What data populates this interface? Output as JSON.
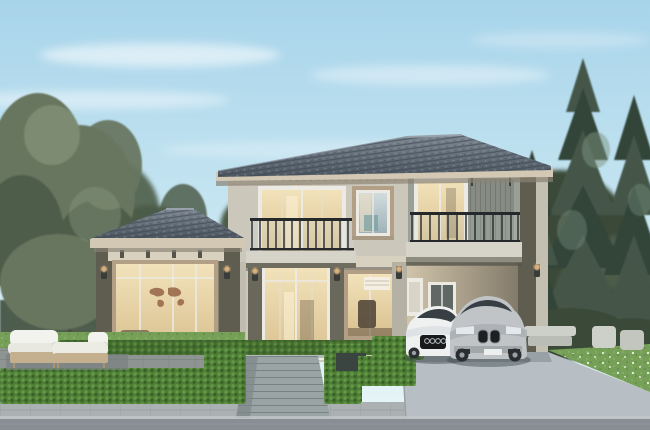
{
  "scene": {
    "type": "architectural-exterior-rendering",
    "caption": "Two-story modern tropical house rendering at dusk with lit interiors, landscaped hedges, patio furniture and two cars parked under a carport",
    "objects": [
      {
        "label": "sky with thin clouds"
      },
      {
        "label": "deciduous tree cluster on left"
      },
      {
        "label": "tall pine trees on right"
      },
      {
        "label": "background tree line and garden fence"
      },
      {
        "label": "two-story house with dark hip tile roofs and greige walls"
      },
      {
        "label": "single-story pavilion wing with large warm-lit window and world-map wall art"
      },
      {
        "label": "center balcony with black railing over glass entrance"
      },
      {
        "label": "right balcony with lit sliding door and slat panel"
      },
      {
        "label": "upper-floor window with tan surround"
      },
      {
        "label": "main glass entrance door, warm lit"
      },
      {
        "label": "study window with desk silhouette"
      },
      {
        "label": "carport with downlights, rear window and white door"
      },
      {
        "label": "wall sconce lamps, lit warm"
      },
      {
        "label": "white sport coupe with four-ring grille"
      },
      {
        "label": "silver SUV with twin kidney grille"
      },
      {
        "label": "trimmed bright-green hedges and planter box"
      },
      {
        "label": "lawn with small white flowers"
      },
      {
        "label": "paved patio with wicker lounge set, white cushions"
      },
      {
        "label": "outdoor chairs on right garden terrace"
      },
      {
        "label": "central paver walkway with steps"
      },
      {
        "label": "concrete driveway"
      },
      {
        "label": "sidewalk and road strip across the bottom"
      }
    ]
  },
  "colors": {
    "sky_top": "#a8d4ea",
    "sky_mid": "#c9e7f2",
    "sky_bottom": "#eaf6f8",
    "bg_tree": "#4d5c49",
    "bg_tree_dark": "#3b4839",
    "left_tree": "#67765f",
    "left_tree_dark": "#4e5d48",
    "left_tree_light": "#8d9c82",
    "pine": "#44564a",
    "pine_dark": "#334439",
    "pine_light": "#7e937f",
    "trunk": "#4d443a",
    "roof_top": "#7e8893",
    "roof_base": "#4e5862",
    "roof_line": "#39424b",
    "fascia_light": "#d3c8b4",
    "fascia_shadow": "#8a8274",
    "wall_light": "#cbc7bb",
    "wall_mid": "#b4b0a3",
    "wall_dark": "#6a685b",
    "pavilion_wall": "#84816e",
    "pier_dark": "#5f5d50",
    "frieze": "#d8d1c0",
    "glass_warm": "#f2e2ba",
    "glass_warm2": "#d9c190",
    "glass_cool": "#b9c7cc",
    "glass_teal": "#7ba2a4",
    "frame_white": "#eceae2",
    "frame_tan": "#b29f86",
    "railing": "#26292b",
    "slab": "#d6d3c9",
    "soffit": "#6f6d60",
    "sconce": "#3a3c3a",
    "glow": "#ffcf8f",
    "hedge": "#4e7d35",
    "hedge_light": "#68a04a",
    "hedge_dark": "#2e5222",
    "hedge_box": "#3a4440",
    "lawn": "#76a058",
    "flower": "#eef2e6",
    "patio": "#8d9492",
    "walk": "#9aa4a4",
    "step_light": "#b4baba",
    "sidewalk": "#abb1b2",
    "road": "#878e94",
    "drive": "#b7bfc4",
    "car_white": "#eff1f1",
    "car_silver": "#c0c4c6",
    "car_glass": "#383f44",
    "tire": "#2a2e31",
    "map_brown": "#9a6a4c",
    "interior_dark": "#5e5140"
  }
}
